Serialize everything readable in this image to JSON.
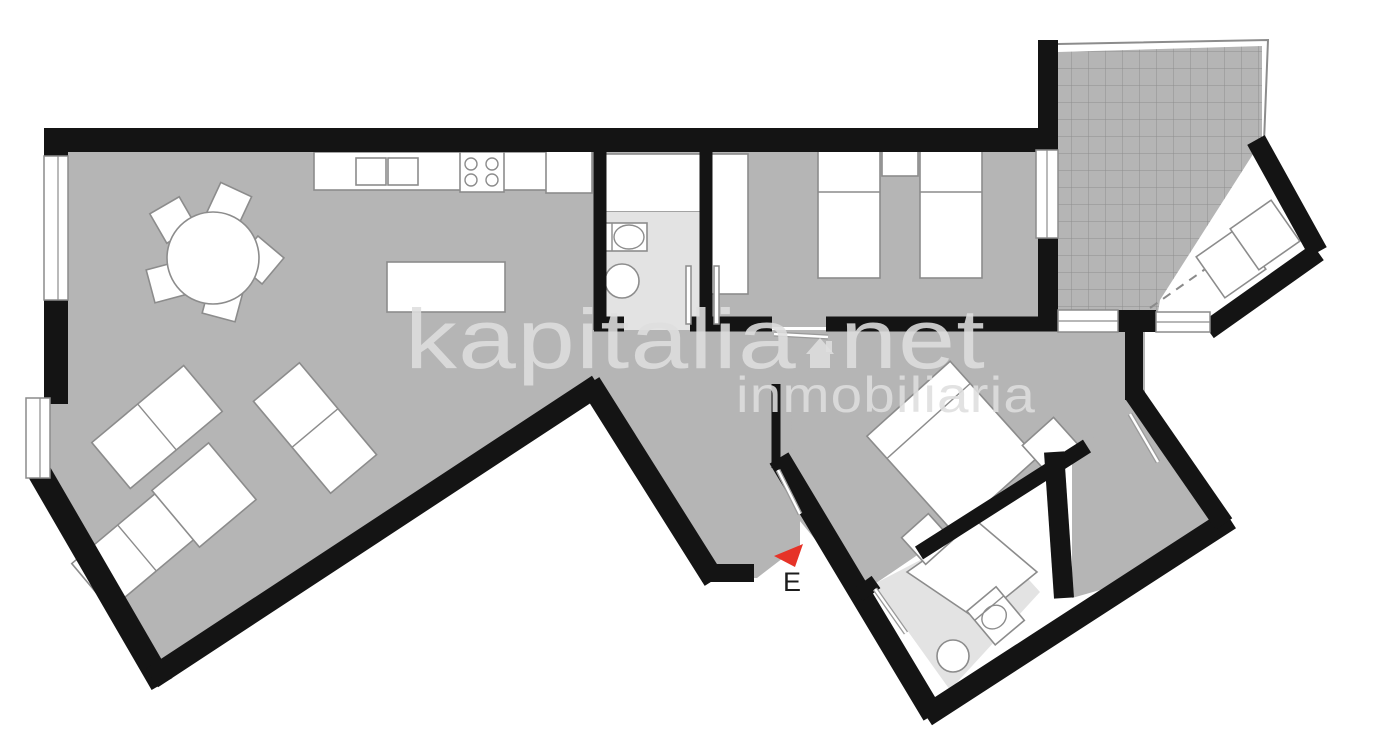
{
  "watermark": {
    "brand": "kapitalia",
    "tld": "net",
    "tagline": "inmobiliaria"
  },
  "entrance": {
    "label": "E"
  },
  "colors": {
    "wall": "#141414",
    "floor": "#b5b5b5",
    "bath": "#e3e3e3",
    "stroke": "#8c8c8c",
    "grid": "#8e8e8e",
    "watermark": "#dedede",
    "accent": "#e63328",
    "ink": "#1c1c1c",
    "background": "#ffffff"
  }
}
